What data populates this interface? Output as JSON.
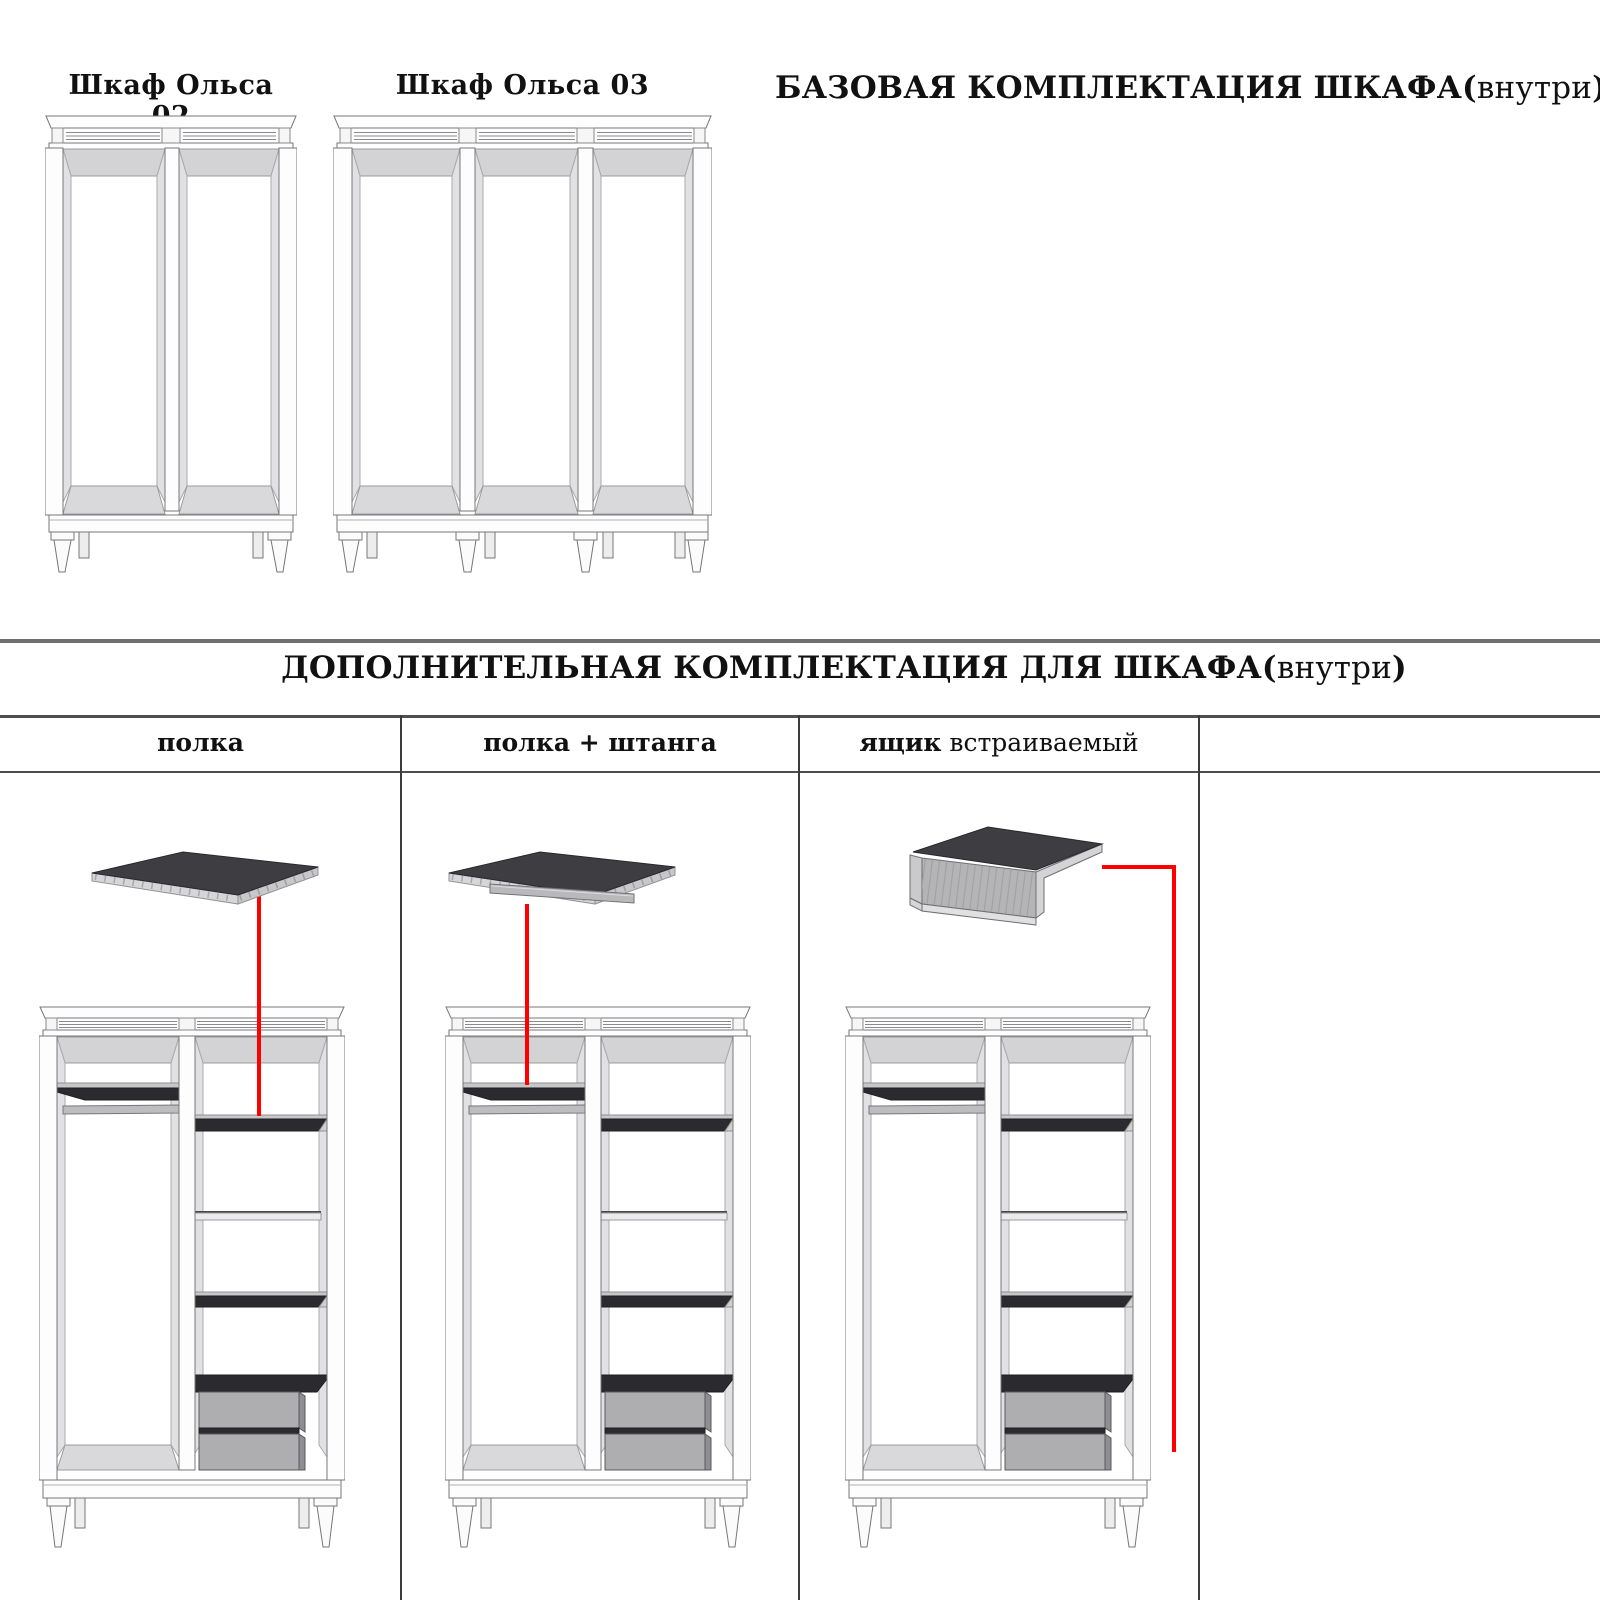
{
  "page": {
    "width": 1600,
    "height": 1600,
    "background": "#ffffff"
  },
  "colors": {
    "annotation_red": "#ff0000",
    "section_divider": "#6f6f6f",
    "table_border": "#4e4e4e",
    "column_line": "#3c3c3c",
    "shelf_dark": "#2b2b2f",
    "drawer_gray": "#aeaeb1",
    "interior_gray": "#d3d3d6",
    "outline_gray": "#77777a"
  },
  "base_section": {
    "wardrobe_02_label": "Шкаф Ольса 02",
    "wardrobe_03_label": "Шкаф Ольса 03",
    "heading": {
      "bold": "БАЗОВАЯ КОМПЛЕКТАЦИЯ ШКАФА(",
      "light": "внутри",
      "close": ")"
    }
  },
  "extras_section": {
    "heading": {
      "bold": "ДОПОЛНИТЕЛЬНАЯ КОМПЛЕКТАЦИЯ ДЛЯ ШКАФА(",
      "light": "внутри",
      "close": ")"
    },
    "table_headers": [
      {
        "bold": "полка",
        "light": ""
      },
      {
        "bold": "полка + штанга",
        "light": ""
      },
      {
        "bold": "ящик",
        "light": " встраиваемый"
      },
      {
        "bold": "",
        "light": ""
      }
    ]
  }
}
